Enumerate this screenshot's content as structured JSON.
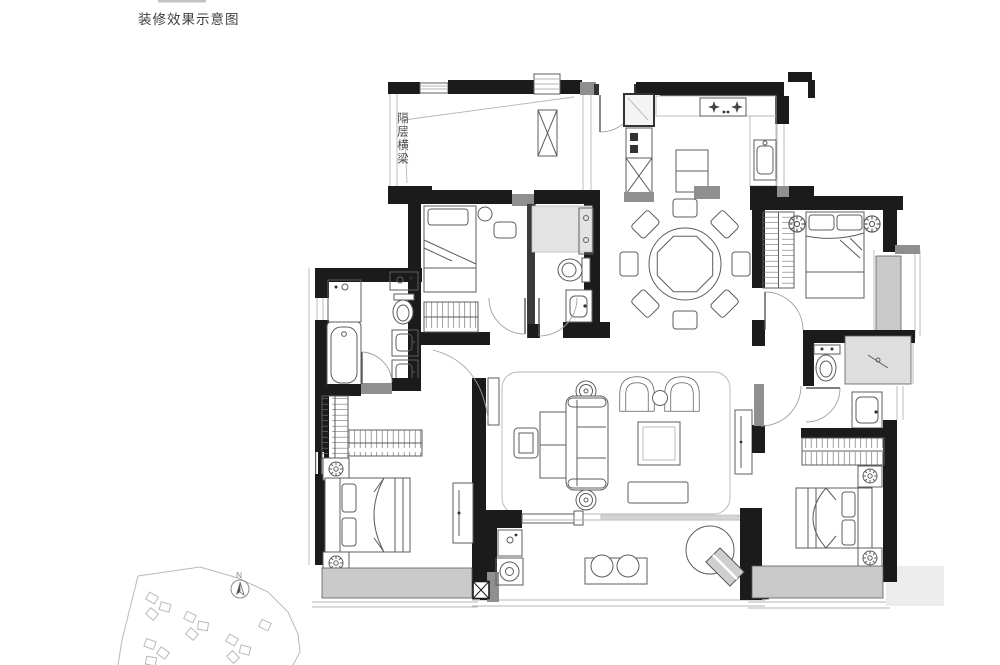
{
  "title": {
    "text": "装修效果示意图"
  },
  "plan": {
    "beam_label": "隔层横梁"
  },
  "site_plan": {
    "compass_label": "N"
  },
  "colors": {
    "wall": "#1b1b1b",
    "wall-gray": "#8f8f8f",
    "line": "#5c5c5c",
    "faint": "#b5b5b5",
    "light": "#dedede",
    "bay": "#c9c9c9",
    "title-ink": "#3f3f3f"
  }
}
